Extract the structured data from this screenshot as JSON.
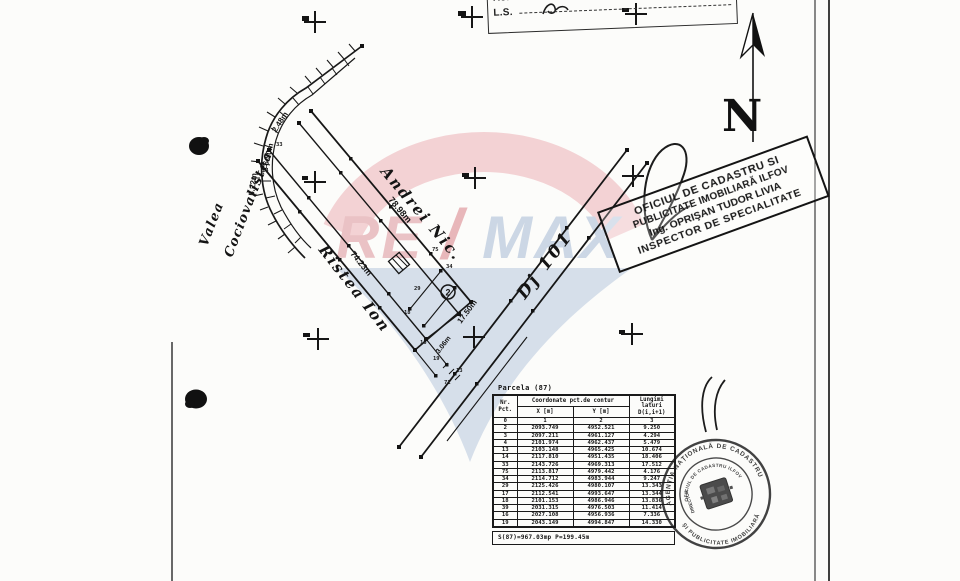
{
  "document": {
    "referent_box": {
      "row1_label": "Referent",
      "row2_label": "L.S."
    },
    "north_arrow_label": "N"
  },
  "map": {
    "stream_label": [
      "Valea",
      "Cociovalistea"
    ],
    "north_neighbor_label": "Andrei Nic.",
    "north_boundary_length": "78.98m",
    "south_neighbor_label": "Ristea Ion",
    "south_boundary_length": "74.23m",
    "road_label": "Dj 101",
    "dim_labels": {
      "d1": "2.48m",
      "d2": "6.50m",
      "d3": "5.22m",
      "front": "17.50m",
      "small": "3.06m"
    },
    "parcel_number_circled": "2",
    "point_labels": [
      "33",
      "14",
      "75",
      "34",
      "29",
      "18",
      "16",
      "19",
      "71",
      "13"
    ]
  },
  "inspector_stamp": {
    "line1": "OFICIUL DE CADASTRU SI",
    "line2": "PUBLICITATE IMOBILIARĂ ILFOV",
    "line3": "Ing. OPRIŞAN TUDOR LIVIA",
    "line4": "INSPECTOR DE SPECIALITATE"
  },
  "round_stamp": {
    "outer_top": "AGENȚIA NAȚIONALĂ DE CADASTRU",
    "outer_bottom": "ȘI PUBLICITATE IMOBILIARĂ",
    "inner": "OFICIUL DE CADASTRU ILFOV",
    "side": "DIRECTOR"
  },
  "watermark": {
    "re": "RE",
    "slash": "/",
    "max": "MAX",
    "red_hex": "#eac2c5",
    "blue_hex": "#ccd7e5"
  },
  "table": {
    "title": "Parcela (87)",
    "headers": {
      "nr": "Nr. Pct.",
      "coord_group": "Coordonate pct.de contur",
      "x": "X [m]",
      "y": "Y [m]",
      "len": "Lungimi laturi D(i,i+1)"
    },
    "index_row": [
      "0",
      "1",
      "2",
      "3"
    ],
    "rows": [
      [
        "2",
        "2093.749",
        "4952.521",
        "9.250"
      ],
      [
        "3",
        "2097.211",
        "4961.127",
        "4.294"
      ],
      [
        "4",
        "2101.974",
        "4962.437",
        "5.479"
      ],
      [
        "13",
        "2103.148",
        "4965.425",
        "10.674"
      ],
      [
        "14",
        "2117.810",
        "4951.435",
        "18.406"
      ],
      [
        "33",
        "2143.726",
        "4969.313",
        "17.512"
      ],
      [
        "75",
        "2113.817",
        "4979.442",
        "4.176"
      ],
      [
        "34",
        "2114.712",
        "4983.944",
        "9.247"
      ],
      [
        "29",
        "2125.426",
        "4980.107",
        "13.343"
      ],
      [
        "17",
        "2112.541",
        "4993.647",
        "13.344"
      ],
      [
        "18",
        "2101.153",
        "4986.946",
        "13.836"
      ],
      [
        "39",
        "2031.315",
        "4976.503",
        "11.414"
      ],
      [
        "16",
        "2027.108",
        "4956.936",
        "7.336"
      ],
      [
        "19",
        "2043.149",
        "4994.847",
        "14.330"
      ]
    ],
    "footer": "S(87)=967.03mp   P=199.45m"
  }
}
